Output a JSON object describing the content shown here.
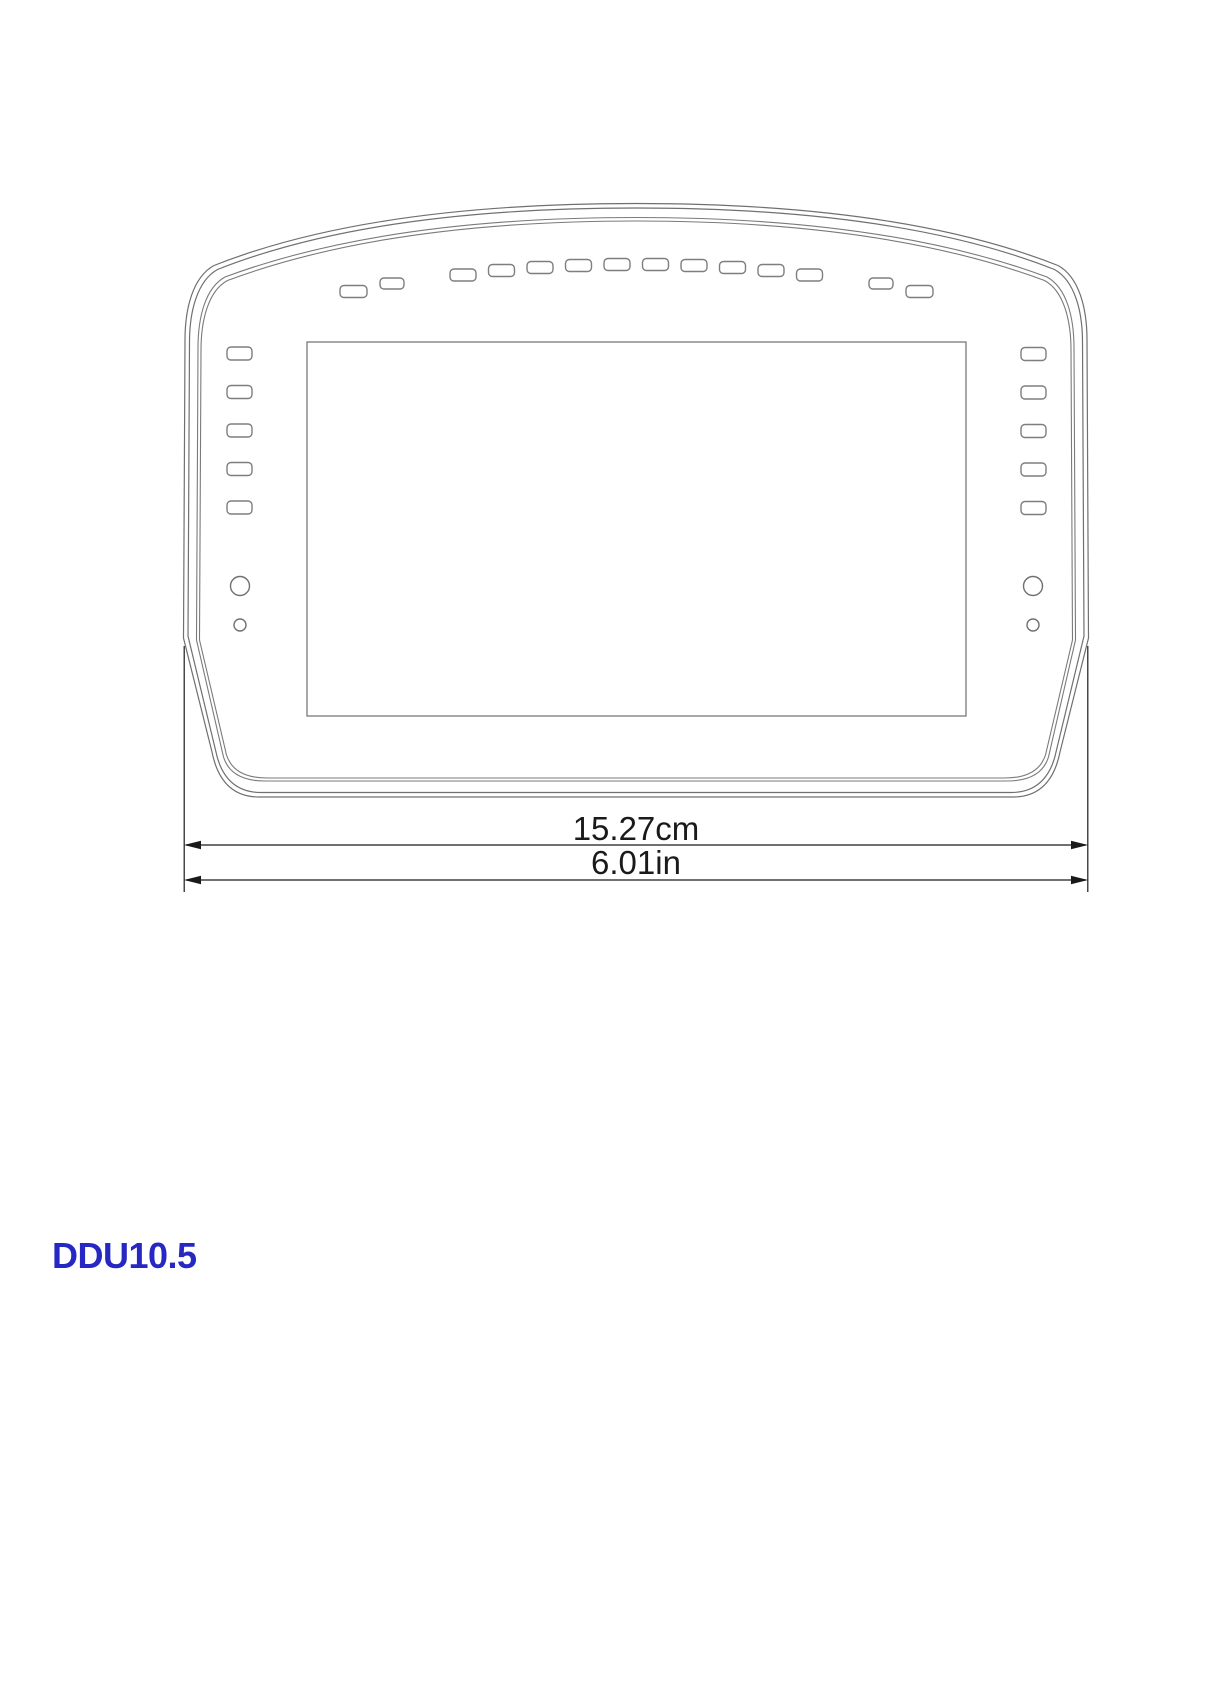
{
  "device": {
    "label": "DDU10.5"
  },
  "dimension_annotations": {
    "metric": "15.27cm",
    "imperial": "6.01in"
  },
  "colors": {
    "outline_gray": "#707070",
    "led_gray": "#7e7e7e",
    "dimension_black": "#1a1a1a",
    "label_blue": "#2727c4",
    "background": "#ffffff"
  },
  "indicator_leds": {
    "top_arc": {
      "count": 10,
      "w": 26,
      "h": 12,
      "r": 4,
      "positions": [
        [
          450,
          269
        ],
        [
          488.5,
          264.5
        ],
        [
          527,
          261.5
        ],
        [
          565.5,
          259.5
        ],
        [
          604,
          258.5
        ],
        [
          642.5,
          258.5
        ],
        [
          681,
          259.5
        ],
        [
          719.5,
          261.5
        ],
        [
          758,
          264.5
        ],
        [
          796.5,
          269
        ]
      ]
    },
    "top_left_pair": {
      "count": 2,
      "r": 4,
      "rects": [
        [
          340,
          285.5,
          27,
          12
        ],
        [
          380,
          278,
          24,
          11
        ]
      ]
    },
    "top_right_pair": {
      "count": 2,
      "r": 4,
      "rects": [
        [
          869,
          278,
          24,
          11
        ],
        [
          906,
          285.5,
          27,
          12
        ]
      ]
    },
    "left_column": {
      "count": 5,
      "w": 25,
      "h": 13,
      "r": 4,
      "x": 227,
      "ys": [
        347,
        385.5,
        424,
        462.5,
        501
      ]
    },
    "right_column": {
      "count": 5,
      "w": 25,
      "h": 13,
      "r": 4,
      "x": 1021,
      "ys": [
        347.5,
        386,
        424.5,
        463,
        501.5
      ]
    }
  },
  "buttons": {
    "left": [
      {
        "cx": 240,
        "cy": 586,
        "r": 9.5
      },
      {
        "cx": 240,
        "cy": 625,
        "r": 6
      }
    ],
    "right": [
      {
        "cx": 1033,
        "cy": 586,
        "r": 9.5
      },
      {
        "cx": 1033,
        "cy": 625,
        "r": 6
      }
    ]
  }
}
